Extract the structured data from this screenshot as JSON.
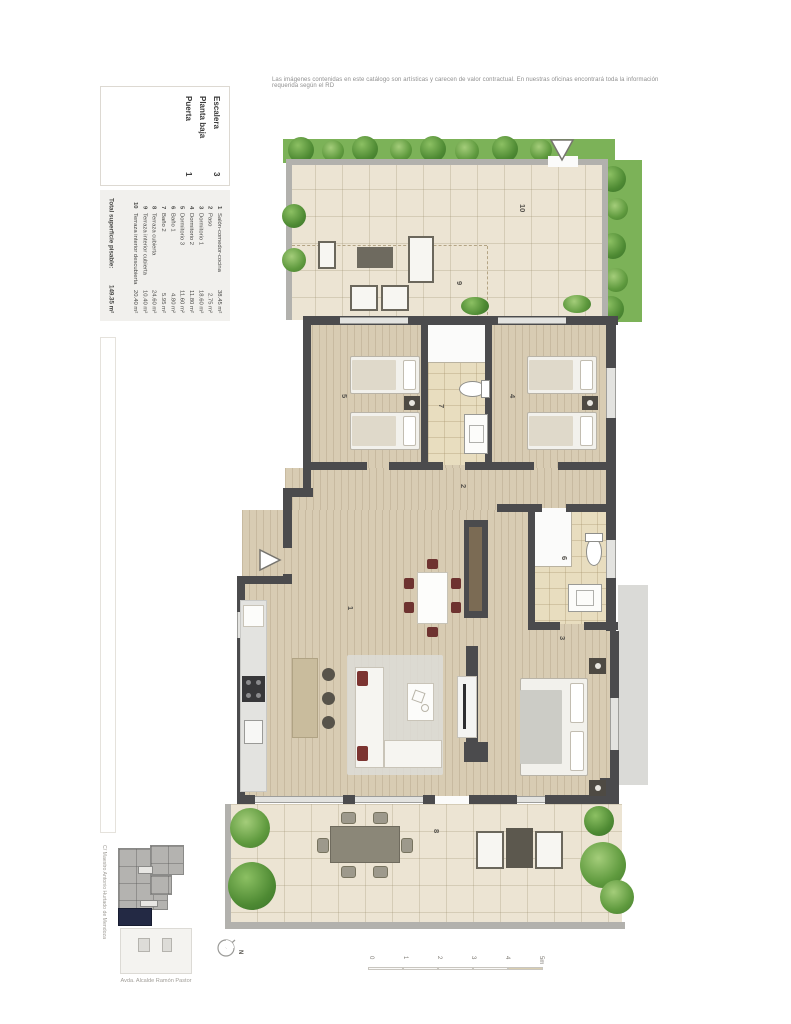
{
  "disclaimer": "Las imágenes contenidas en este catálogo son artísticas y carecen de valor contractual. En nuestras oficinas encontrará toda la información requerida según el RD",
  "unit_info": {
    "rows": [
      {
        "label": "Escalera",
        "value": "3"
      },
      {
        "label": "Planta baja",
        "value": ""
      },
      {
        "label": "Puerta",
        "value": "1"
      }
    ]
  },
  "legend": {
    "items": [
      {
        "num": "1",
        "name": "Salón-comedor-cocina",
        "area": "38.45 m²"
      },
      {
        "num": "2",
        "name": "Paso",
        "area": "2.75 m²"
      },
      {
        "num": "3",
        "name": "Dormitorio 1",
        "area": "18.60 m²"
      },
      {
        "num": "4",
        "name": "Dormitorio 2",
        "area": "11.80 m²"
      },
      {
        "num": "5",
        "name": "Dormitorio 3",
        "area": "11.60 m²"
      },
      {
        "num": "6",
        "name": "Baño 1",
        "area": "4.80 m²"
      },
      {
        "num": "7",
        "name": "Baño 2",
        "area": "5.95 m²"
      },
      {
        "num": "8",
        "name": "Terraza cubierta",
        "area": "24.60 m²"
      },
      {
        "num": "9",
        "name": "Terraza interior cubierta",
        "area": "10.40 m²"
      },
      {
        "num": "10",
        "name": "Terraza interior descubierta",
        "area": "20.40 m²"
      }
    ],
    "total_label": "Total superficie pisable:",
    "total_value": "149.35 m²"
  },
  "plan_labels": {
    "salon": "1",
    "paso": "2",
    "dormitorio1": "3",
    "dormitorio2": "4",
    "dormitorio3": "5",
    "bano1": "6",
    "bano2": "7",
    "terraza_cubierta": "8",
    "terraza_interior_cubierta": "9",
    "terraza_interior_descubierta": "10"
  },
  "site_map": {
    "street_left": "C/ Maestro Antonio Hurtado de Mendoza",
    "street_bottom": "Avda. Alcalde Ramón Pastor"
  },
  "compass": {
    "label": "N"
  },
  "scale_bar": {
    "ticks": [
      "0",
      "1",
      "2",
      "3",
      "4",
      "5m"
    ]
  },
  "colors": {
    "wall": "#4b4b4d",
    "wood_floor": "#d8ccb3",
    "terrace_tile": "#ece4d3",
    "bath_tile": "#e8ddbf",
    "plant_green": "#4e8a33",
    "accent_navy": "#232944",
    "maroon_accent": "#6e3330"
  }
}
